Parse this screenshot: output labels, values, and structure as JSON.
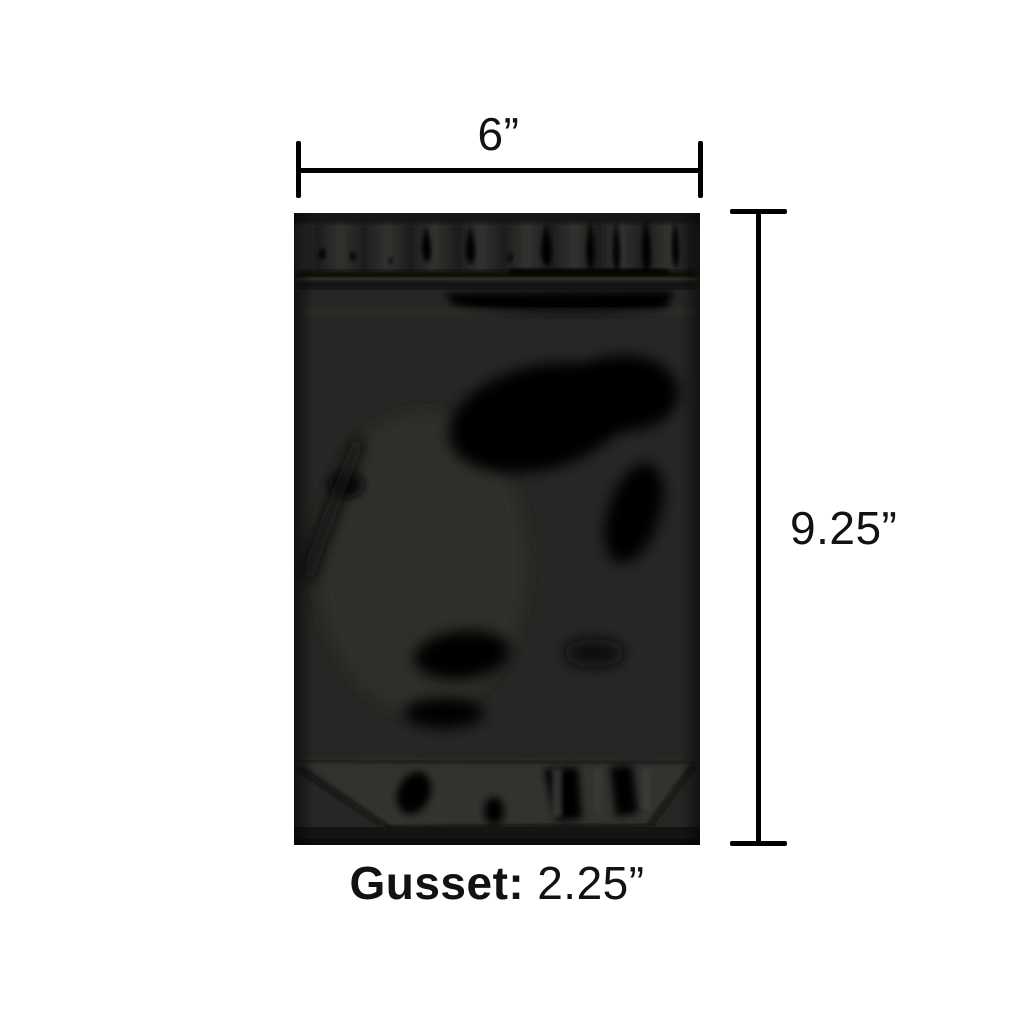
{
  "diagram": {
    "type": "product-dimension-diagram",
    "labels": {
      "width": "6”",
      "height": "9.25”",
      "gusset_title": "Gusset:",
      "gusset_value": "2.25”"
    },
    "measurements": {
      "width_inches": 6,
      "height_inches": 9.25,
      "gusset_inches": 2.25
    }
  },
  "colors": {
    "page-bg": "#ffffff",
    "dim-line": "#000000",
    "label-text": "#121212",
    "bag-base": "#262624",
    "bag-sheen": "#343432",
    "bag-gloss-shadow": "#040404"
  }
}
